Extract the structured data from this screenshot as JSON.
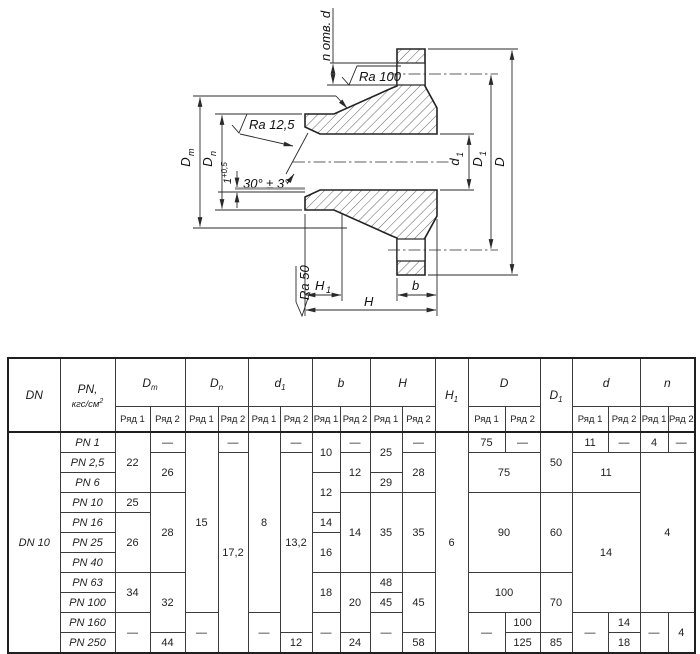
{
  "drawing": {
    "n_otv_d": "n отв. d",
    "ra100": "Ra 100",
    "ra125": "Ra 12,5",
    "ra50": "Ra 50",
    "angle": "30° ± 3°",
    "step_main": "1",
    "step_sup": "+0,5",
    "dm_main": "D",
    "dm_sub": "m",
    "dn_main": "D",
    "dn_sub": "n",
    "d1_main": "d",
    "d1_sub": "1",
    "bigd1_main": "D",
    "bigd1_sub": "1",
    "bigd": "D",
    "h1_main": "H",
    "h1_sub": "1",
    "h": "H",
    "b": "b"
  },
  "table": {
    "header": {
      "pn_unit": "кгс/см",
      "pn_sup": "2",
      "ryad": [
        "Ряд 1",
        "Ряд 2"
      ],
      "cols": [
        {
          "main": "DN"
        },
        {
          "main": "PN,",
          "unit": true
        },
        {
          "main": "D",
          "sub": "m",
          "span": 2
        },
        {
          "main": "D",
          "sub": "n",
          "span": 2
        },
        {
          "main": "d",
          "sub": "1",
          "span": 2
        },
        {
          "main": "b",
          "span": 2
        },
        {
          "main": "H",
          "span": 2
        },
        {
          "main": "H",
          "sub": "1"
        },
        {
          "main": "D",
          "span": 2
        },
        {
          "main": "D",
          "sub": "1"
        },
        {
          "main": "d",
          "span": 2
        },
        {
          "main": "n",
          "span": 2
        }
      ]
    },
    "rows": [
      {
        "cells": [
          {
            "v": "DN 10",
            "rs": 11,
            "cls": "dn"
          },
          {
            "v": "PN 1",
            "cls": "pn"
          },
          {
            "v": "22",
            "rs": 3
          },
          {
            "v": "—"
          },
          {
            "v": "15",
            "rs": 9
          },
          {
            "v": "—"
          },
          {
            "v": "8",
            "rs": 9
          },
          {
            "v": "—"
          },
          {
            "v": "10",
            "rs": 2
          },
          {
            "v": "—"
          },
          {
            "v": "25",
            "rs": 2
          },
          {
            "v": "—"
          },
          {
            "v": "6",
            "rs": 11
          },
          {
            "v": "75"
          },
          {
            "v": "—"
          },
          {
            "v": "50",
            "rs": 3
          },
          {
            "v": "11"
          },
          {
            "v": "—"
          },
          {
            "v": "4"
          },
          {
            "v": "—"
          }
        ]
      },
      {
        "cells": [
          {
            "v": "PN 2,5",
            "cls": "pn"
          },
          {
            "v": "26",
            "rs": 2
          },
          {
            "v": "17,2",
            "rs": 10
          },
          {
            "v": "13,2",
            "rs": 9
          },
          {
            "v": "12",
            "rs": 2
          },
          {
            "v": "28",
            "rs": 2
          },
          {
            "v": "75",
            "rs": 2,
            "cs": 2
          },
          {
            "v": "11",
            "rs": 2,
            "cs": 2
          },
          {
            "v": "4",
            "rs": 8,
            "cs": 2
          }
        ]
      },
      {
        "cells": [
          {
            "v": "PN 6",
            "cls": "pn"
          },
          {
            "v": "12",
            "rs": 2
          },
          {
            "v": "29"
          }
        ]
      },
      {
        "cells": [
          {
            "v": "PN 10",
            "cls": "pn"
          },
          {
            "v": "25"
          },
          {
            "v": "28",
            "rs": 4
          },
          {
            "v": "14",
            "rs": 4
          },
          {
            "v": "35",
            "rs": 4
          },
          {
            "v": "35",
            "rs": 4
          },
          {
            "v": "90",
            "rs": 4,
            "cs": 2
          },
          {
            "v": "60",
            "rs": 4
          },
          {
            "v": "14",
            "rs": 6,
            "cs": 2
          }
        ]
      },
      {
        "cells": [
          {
            "v": "PN 16",
            "cls": "pn"
          },
          {
            "v": "26",
            "rs": 3
          },
          {
            "v": "14"
          }
        ]
      },
      {
        "cells": [
          {
            "v": "PN 25",
            "cls": "pn"
          },
          {
            "v": "16",
            "rs": 2
          }
        ]
      },
      {
        "cells": [
          {
            "v": "PN 40",
            "cls": "pn"
          }
        ]
      },
      {
        "cells": [
          {
            "v": "PN 63",
            "cls": "pn"
          },
          {
            "v": "34",
            "rs": 2
          },
          {
            "v": "32",
            "rs": 3
          },
          {
            "v": "18",
            "rs": 2
          },
          {
            "v": "20",
            "rs": 3
          },
          {
            "v": "48"
          },
          {
            "v": "45",
            "rs": 3
          },
          {
            "v": "100",
            "rs": 2,
            "cs": 2
          },
          {
            "v": "70",
            "rs": 3
          }
        ]
      },
      {
        "cells": [
          {
            "v": "PN 100",
            "cls": "pn"
          },
          {
            "v": "45"
          }
        ]
      },
      {
        "cells": [
          {
            "v": "PN 160",
            "cls": "pn"
          },
          {
            "v": "—",
            "rs": 2
          },
          {
            "v": "—",
            "rs": 2
          },
          {
            "v": "—",
            "rs": 2
          },
          {
            "v": "—",
            "rs": 2
          },
          {
            "v": "—",
            "rs": 2
          },
          {
            "v": "—",
            "rs": 2
          },
          {
            "v": "100"
          },
          {
            "v": "—",
            "rs": 2
          },
          {
            "v": "14"
          },
          {
            "v": "—",
            "rs": 2
          },
          {
            "v": "4",
            "rs": 2
          }
        ]
      },
      {
        "cells": [
          {
            "v": "PN 250",
            "cls": "pn"
          },
          {
            "v": "44"
          },
          {
            "v": "12"
          },
          {
            "v": "24"
          },
          {
            "v": "58"
          },
          {
            "v": "125"
          },
          {
            "v": "85"
          },
          {
            "v": "18"
          }
        ]
      }
    ]
  }
}
